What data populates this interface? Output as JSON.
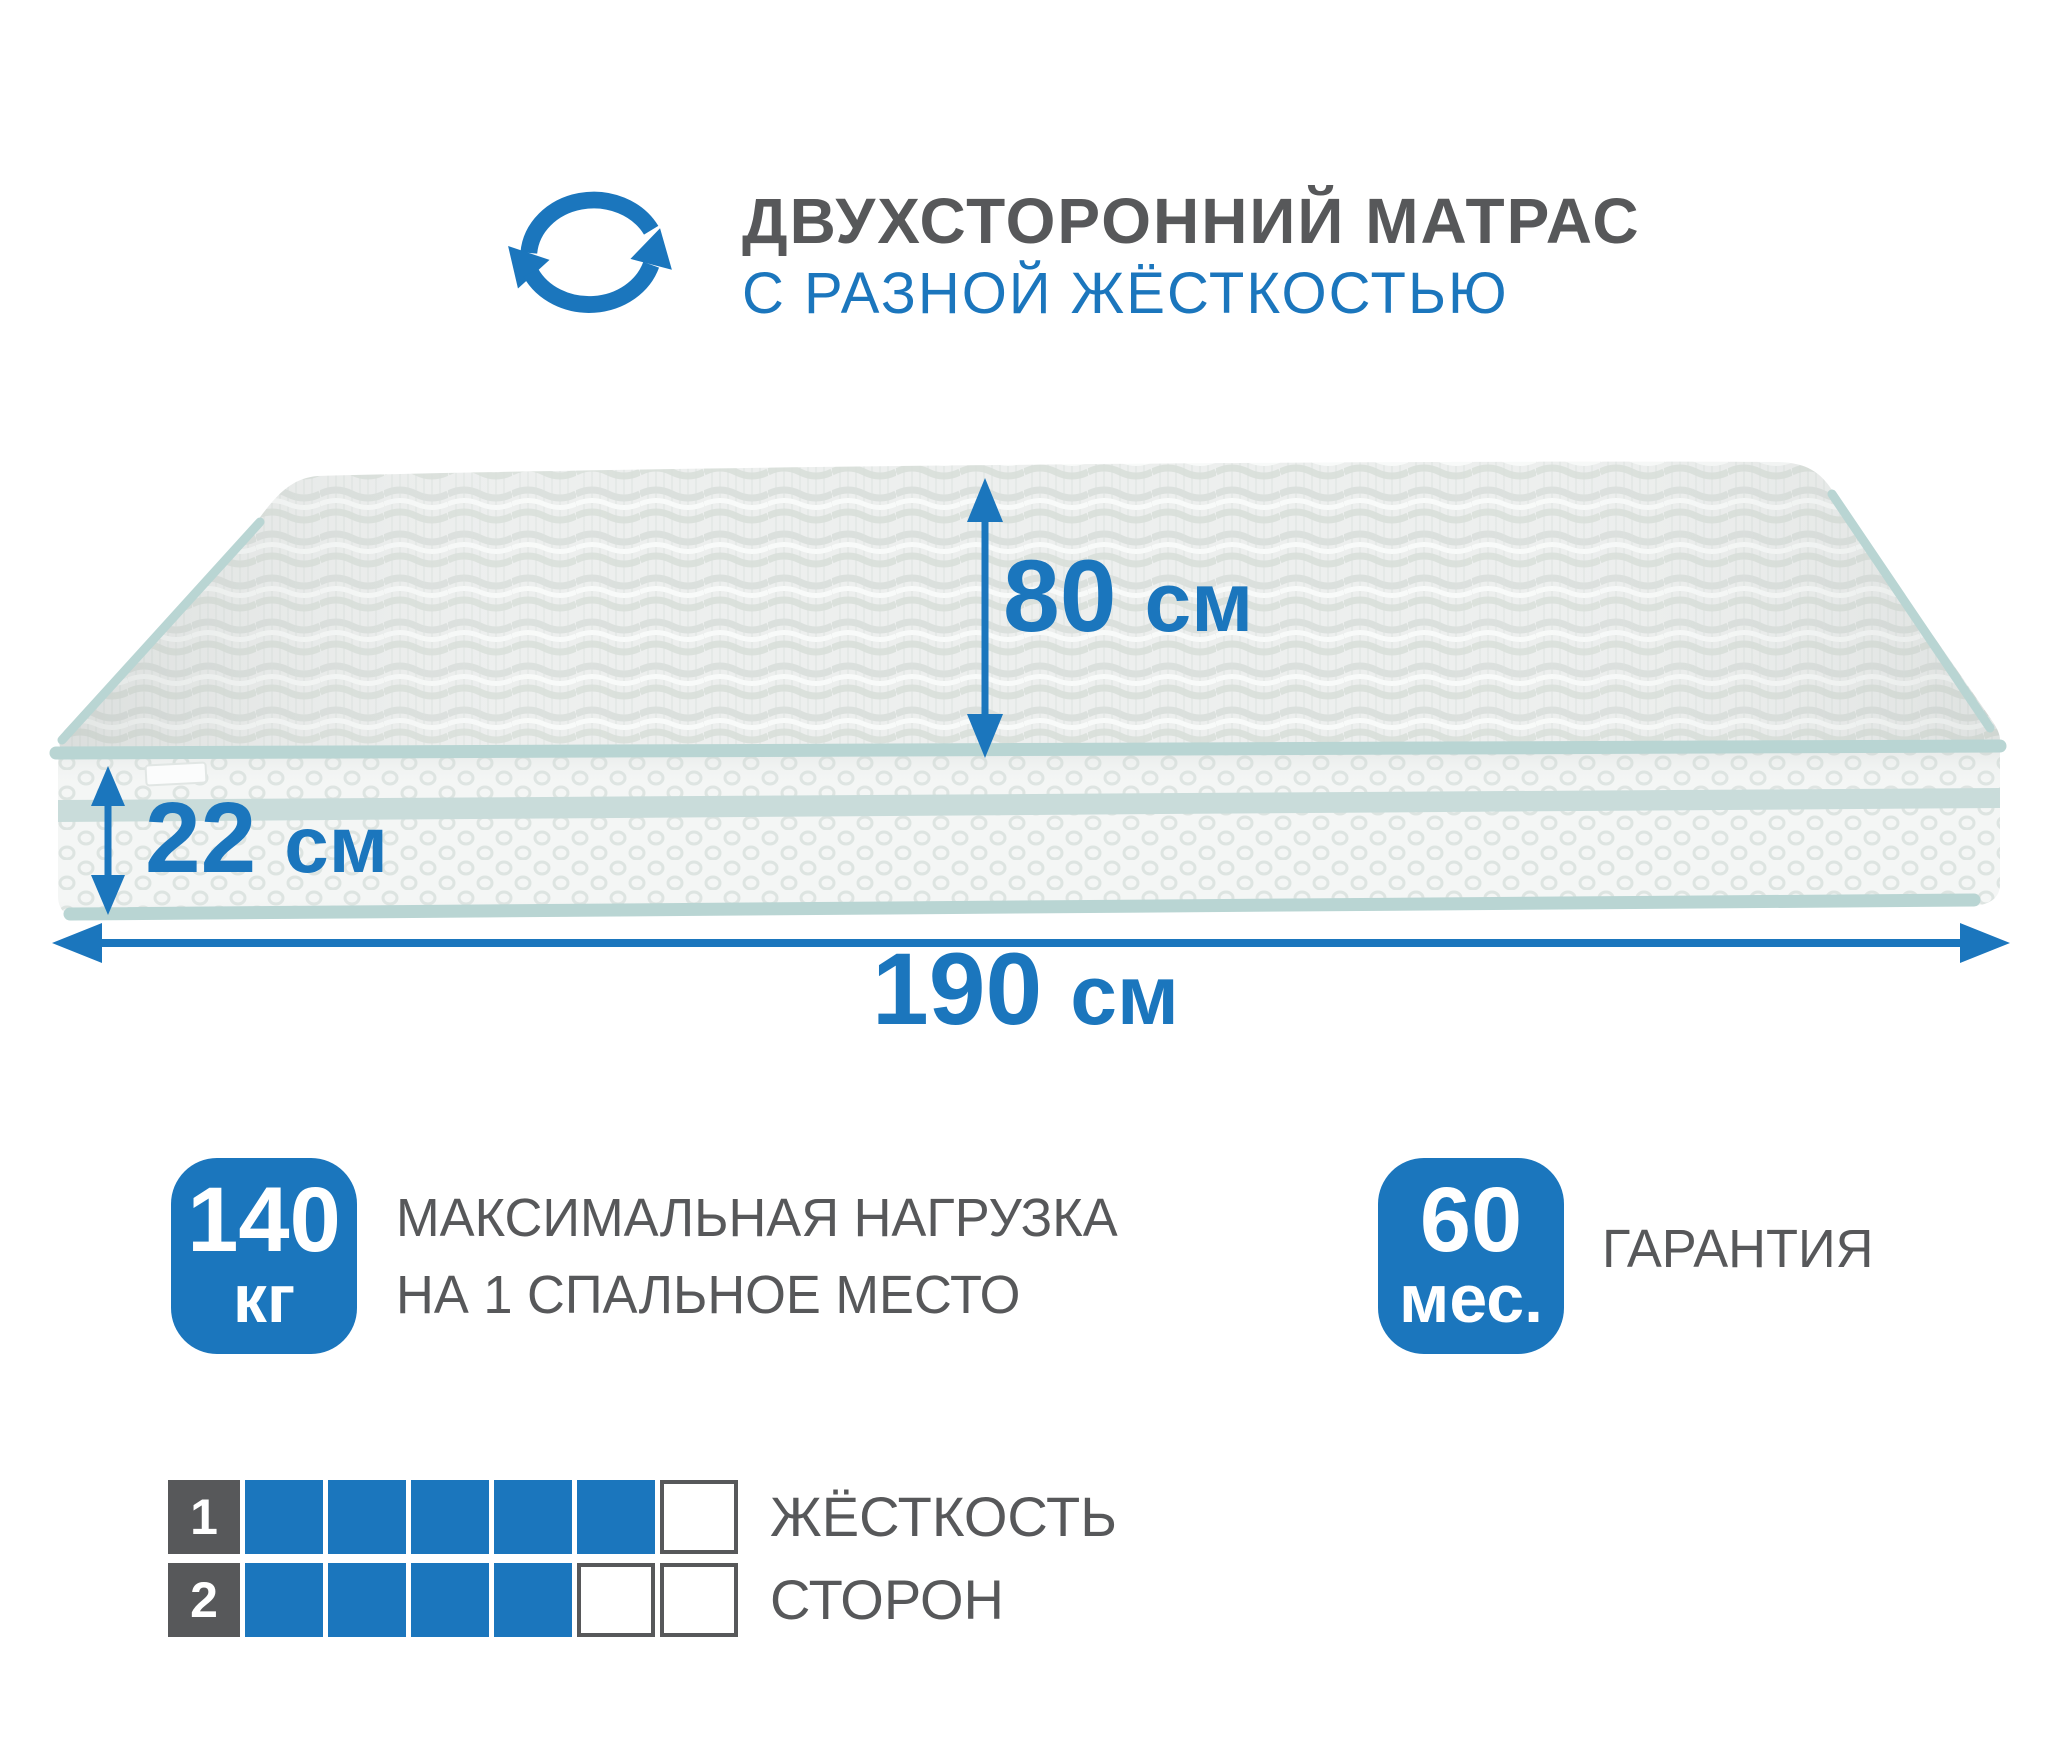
{
  "accent_color": "#1b76bd",
  "text_color": "#57585a",
  "piping_color": "#b9d5d3",
  "header": {
    "title": "ДВУХСТОРОННИЙ МАТРАС",
    "subtitle": "С РАЗНОЙ ЖЁСТКОСТЬЮ"
  },
  "dimensions": {
    "depth": {
      "value": "80",
      "unit": "см"
    },
    "height": {
      "value": "22",
      "unit": "см"
    },
    "length": {
      "value": "190",
      "unit": "см"
    }
  },
  "badges": {
    "max_load": {
      "value": "140",
      "unit": "кг",
      "label_line1": "МАКСИМАЛЬНАЯ НАГРУЗКА",
      "label_line2": "НА 1 СПАЛЬНОЕ МЕСТО"
    },
    "warranty": {
      "value": "60",
      "unit": "мес.",
      "label": "ГАРАНТИЯ"
    }
  },
  "firmness": {
    "label_line1": "ЖЁСТКОСТЬ",
    "label_line2": "СТОРОН",
    "scale_max": 6,
    "sides": [
      {
        "number": "1",
        "filled": 5
      },
      {
        "number": "2",
        "filled": 4
      }
    ]
  }
}
